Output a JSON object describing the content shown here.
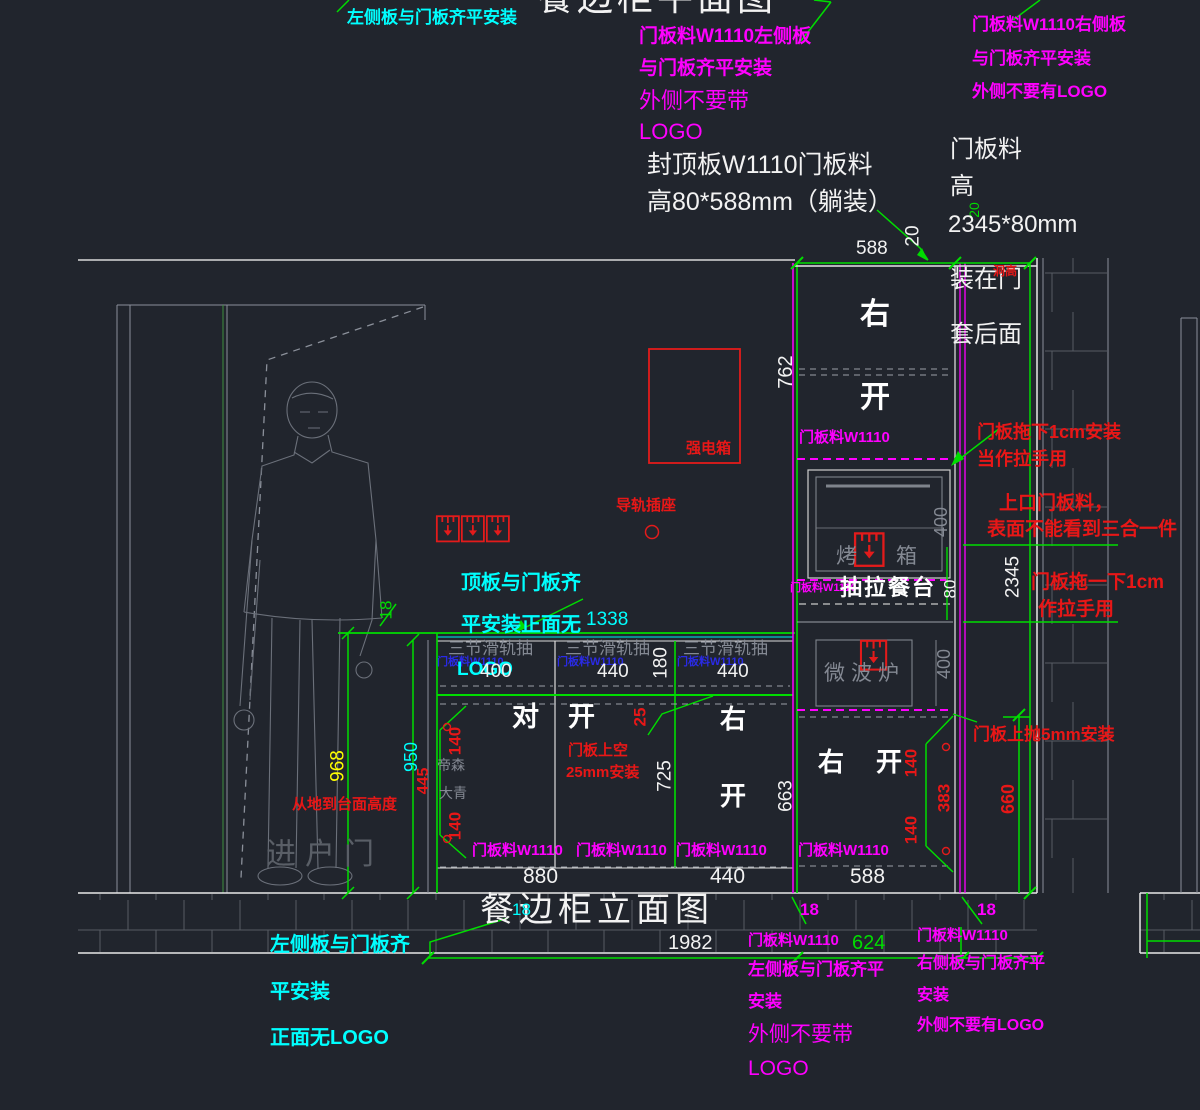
{
  "titles": {
    "plan": "餐边柜平面图",
    "elevation": "餐边柜立面图"
  },
  "dims": {
    "v18": "18",
    "v20": "20",
    "v25": "25",
    "v80": "80",
    "v140": "140",
    "v180": "180",
    "v383": "383",
    "v400": "400",
    "v440": "440",
    "v445": "445",
    "v588": "588",
    "v624": "624",
    "v660": "660",
    "v663": "663",
    "v725": "725",
    "v762": "762",
    "v880": "880",
    "v950": "950",
    "v968": "968",
    "v1338": "1338",
    "v1982": "1982",
    "v2345": "2345"
  },
  "labels": {
    "door_panel_w1110": "门板料W1110",
    "slide_drawer": "三节滑轨抽",
    "pull_table": "抽拉餐台",
    "oven_left": "烤",
    "oven_right": "箱",
    "microwave": "微波炉",
    "right": "右",
    "open": "开",
    "pair_left": "对",
    "entry_door": "进户门",
    "brand_top": "帝森",
    "brand_bottom": "大青",
    "strong_box": "强电箱",
    "rail_socket": "导轨插座",
    "hole_height": "洞高"
  },
  "notes": {
    "cyan_top": "左侧板与门板齐平安装",
    "magenta_tl": [
      "门板料W1110左侧板",
      "与门板齐平安装",
      "外侧不要带",
      "LOGO"
    ],
    "magenta_tr": [
      "门板料W1110右侧板",
      "与门板齐平安装",
      "外侧不要有LOGO"
    ],
    "cap_board": [
      "封顶板W1110门板料",
      "高80*588mm（躺装）"
    ],
    "door_mat": [
      "门板料",
      "高",
      "2345*80mm",
      "装在门",
      "套后面"
    ],
    "drag_down": [
      "门板拖下1cm安装",
      "当作拉手用"
    ],
    "top_mouth": [
      "上口门板料，",
      "表面不能看到三合一件"
    ],
    "drag_once": [
      "门板拖一下1cm",
      "作拉手用"
    ],
    "door_gap": [
      "门板上空",
      "25mm安装"
    ],
    "door_up": "门板上抛5mm安装",
    "floor_height": "从地到台面高度",
    "top_board": [
      "顶板与门板齐",
      "平安装正面无",
      "LOGO"
    ],
    "cyan_bl": [
      "左侧板与门板齐",
      "平安装",
      "正面无LOGO"
    ],
    "magenta_bm": [
      "门板料W1110",
      "左侧板与门板齐平",
      "安装",
      "外侧不要带",
      "LOGO"
    ],
    "magenta_br": [
      "门板料W1110",
      "右侧板与门板齐平",
      "安装",
      "外侧不要有LOGO"
    ]
  },
  "colors": {
    "background": "#21252d",
    "green": "#00dd00",
    "magenta": "#ff00ff",
    "cyan": "#00ffff",
    "red": "#e81717",
    "yellow": "#ffff00",
    "white": "#f2f2f2",
    "blue": "#2a2ae6",
    "gray": "#848993"
  }
}
